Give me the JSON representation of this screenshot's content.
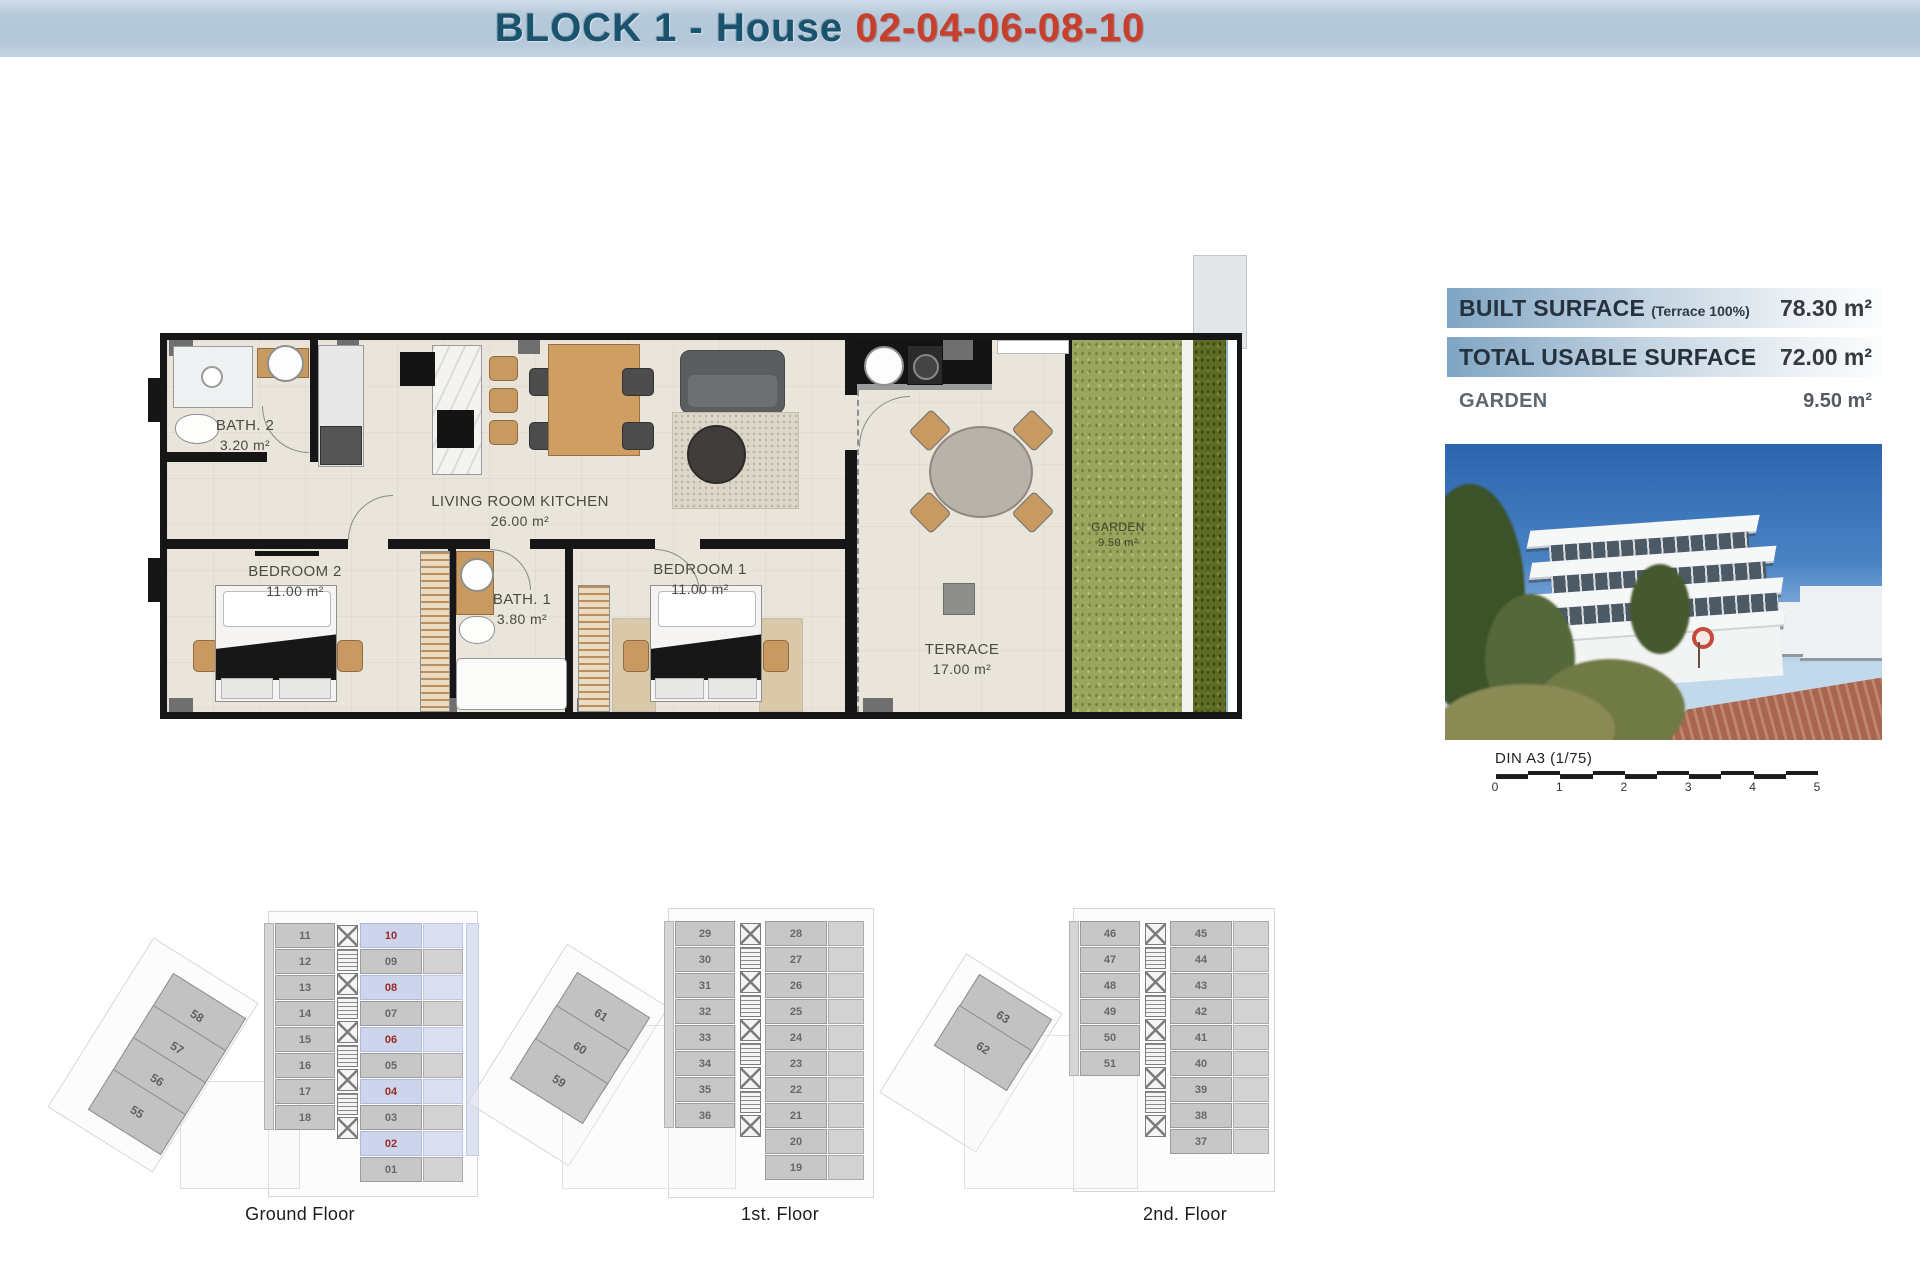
{
  "header": {
    "title_block": "BLOCK 1 - House",
    "title_numbers": "02-04-06-08-10"
  },
  "surfaces": {
    "rows": [
      {
        "label": "BUILT SURFACE",
        "note": "(Terrace 100%)",
        "value": "78.30 m²"
      },
      {
        "label": "TOTAL USABLE SURFACE",
        "note": "",
        "value": "72.00 m²"
      },
      {
        "label": "GARDEN",
        "note": "",
        "value": "9.50 m²"
      }
    ]
  },
  "plan": {
    "rooms": [
      {
        "name": "BATH. 2",
        "area": "3.20 m²"
      },
      {
        "name": "BEDROOM 2",
        "area": "11.00 m²"
      },
      {
        "name": "LIVING ROOM KITCHEN",
        "area": "26.00 m²"
      },
      {
        "name": "BATH. 1",
        "area": "3.80 m²"
      },
      {
        "name": "BEDROOM 1",
        "area": "11.00 m²"
      },
      {
        "name": "TERRACE",
        "area": "17.00 m²"
      },
      {
        "name": "GARDEN",
        "area": "9.50 m²"
      }
    ]
  },
  "scalebar": {
    "label": "DIN A3 (1/75)",
    "ticks": [
      "0",
      "1",
      "2",
      "3",
      "4",
      "5"
    ]
  },
  "floors": [
    {
      "id": "ground",
      "label": "Ground Floor",
      "diagonal": [
        "58",
        "57",
        "56",
        "55"
      ],
      "left": [
        "11",
        "12",
        "13",
        "14",
        "15",
        "16",
        "17",
        "18"
      ],
      "right": [
        "10",
        "09",
        "08",
        "07",
        "06",
        "05",
        "04",
        "03",
        "02",
        "01"
      ],
      "highlighted": [
        "10",
        "08",
        "06",
        "04",
        "02"
      ]
    },
    {
      "id": "first",
      "label": "1st. Floor",
      "diagonal": [
        "61",
        "60",
        "59"
      ],
      "left": [
        "29",
        "30",
        "31",
        "32",
        "33",
        "34",
        "35",
        "36"
      ],
      "right": [
        "28",
        "27",
        "26",
        "25",
        "24",
        "23",
        "22",
        "21",
        "20",
        "19"
      ],
      "highlighted": []
    },
    {
      "id": "second",
      "label": "2nd. Floor",
      "diagonal": [
        "63",
        "62"
      ],
      "left": [
        "46",
        "47",
        "48",
        "49",
        "50",
        "51"
      ],
      "right": [
        "45",
        "44",
        "43",
        "42",
        "41",
        "40",
        "39",
        "38",
        "37"
      ],
      "highlighted": []
    }
  ],
  "colors": {
    "header_blue": "#1a536e",
    "header_red": "#c7402c",
    "band_blue": "#7fa5c3",
    "unit_highlight_bg": "#ccd5ec",
    "unit_highlight_text": "#9c2a23",
    "garden_green": "#99a45c"
  }
}
